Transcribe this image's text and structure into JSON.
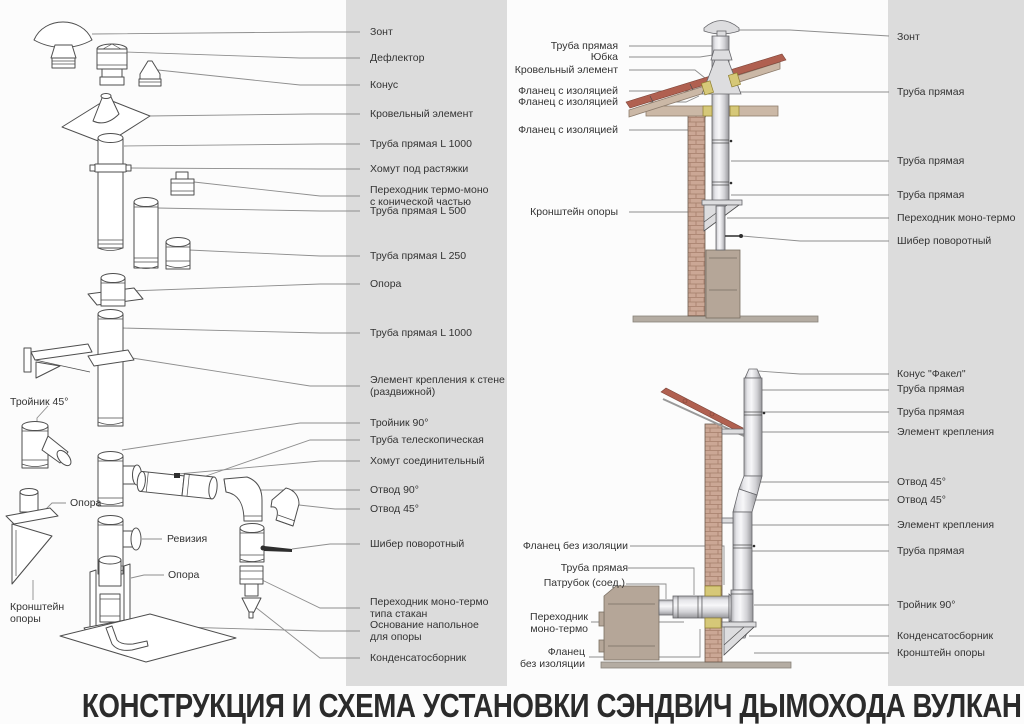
{
  "title": "КОНСТРУКЦИЯ И СХЕМА УСТАНОВКИ СЭНДВИЧ ДЫМОХОДА ВУЛКАН",
  "colors": {
    "band_gray": "#dcdcdc",
    "roof_red": "#b06050",
    "brick": "#cba795",
    "wood": "#cbb8a6",
    "stove": "#b5a698",
    "flange_yellow": "#d6c878",
    "line_art": "#4e4e4e",
    "leader": "#8e8e8e",
    "text": "#333333"
  },
  "parts_list": [
    "Зонт",
    "Дефлектор",
    "Конус",
    "Кровельный элемент",
    "Труба прямая L 1000",
    "Хомут под растяжки",
    "Переходник термо-моно\nс конической частью",
    "Труба прямая L 500",
    "Труба прямая L 250",
    "Опора",
    "Труба прямая L 1000",
    "Элемент крепления к стене\n(раздвижной)",
    "Тройник 90°",
    "Труба телескопическая",
    "Хомут соединительный",
    "Отвод 90°",
    "Отвод 45°",
    "Шибер поворотный",
    "Переходник моно-термо\nтипа стакан",
    "Основание напольное\nдля опоры",
    "Конденсатосборник"
  ],
  "inline_labels": [
    "Тройник 45°",
    "Опора",
    "Ревизия",
    "Опора",
    "Кронштейн\nопоры"
  ],
  "scheme_top": {
    "left": [
      "Труба прямая",
      "Юбка",
      "Кровельный элемент",
      "Фланец с изоляцией",
      "Фланец с изоляцией",
      "Фланец с изоляцией",
      "Кронштейн опоры"
    ],
    "right": [
      "Зонт",
      "Труба прямая",
      "Труба прямая",
      "Труба прямая",
      "Переходник моно-термо",
      "Шибер поворотный"
    ]
  },
  "scheme_bottom": {
    "left": [
      "Фланец без изоляции",
      "Труба прямая",
      "Патрубок (соед.)",
      "Переходник\nмоно-термо",
      "Фланец\nбез изоляции"
    ],
    "right": [
      "Конус \"Факел\"",
      "Труба прямая",
      "Труба прямая",
      "Элемент крепления",
      "Отвод 45°",
      "Отвод 45°",
      "Элемент крепления",
      "Труба прямая",
      "Тройник 90°",
      "Конденсатосборник",
      "Кронштейн опоры"
    ]
  }
}
